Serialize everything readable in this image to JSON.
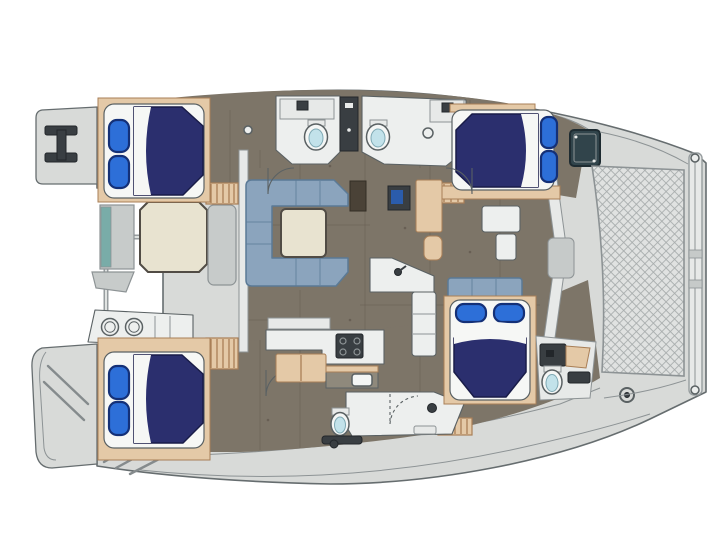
{
  "page": {
    "background": "#ffffff",
    "type": "yacht-floor-plan",
    "view": "top-down",
    "orientation": "bow-right"
  },
  "palette": {
    "paper": "#ffffff",
    "deck": "#d8dad8",
    "deck_mid": "#c6cac9",
    "deck_shadow": "#a9afae",
    "outline": "#666d6f",
    "line": "#5a6163",
    "line_soft": "#8d9395",
    "floor": "#7d7568",
    "floor_seam": "#685f54",
    "wood": "#e4c9a7",
    "wood_edge": "#a97f57",
    "mattress": "#f6f7f5",
    "bed": "#2b2f6e",
    "bed_edge": "#191c48",
    "pillow": "#2d6fd8",
    "pillow_edge": "#143077",
    "sofa": "#8ba4bd",
    "sofa_edge": "#5b7a96",
    "table": "#e8e3d0",
    "table_edge": "#514c45",
    "counter": "#edefee",
    "wall": "#e7e9e8",
    "dark": "#393e42",
    "dark_edge": "#22262a",
    "fixture": "#f4f6f5",
    "basin": "#c2e2ea",
    "basin_edge": "#7fa9b4",
    "rail": "#979d9f",
    "rail_hi": "#e9ebea",
    "step_line": "#858b8d",
    "mesh_bg": "#e0e2e1",
    "mesh_line": "#a7acac",
    "teal": "#79aca8",
    "hatch": "#31444b",
    "hatch_edge": "#1e2b31",
    "screen_blue": "#2b5cab",
    "storage": "#c7cbca"
  },
  "vessel": {
    "layout": "4-cabin catamaran floor plan",
    "hulls": 2,
    "cabins": [
      {
        "id": "aft-top-cabin",
        "bed": "double",
        "pillows": 2
      },
      {
        "id": "forward-top-cabin",
        "bed": "double",
        "pillows": 2
      },
      {
        "id": "aft-bottom-cabin",
        "bed": "double",
        "pillows": 2
      },
      {
        "id": "forward-bottom-cabin",
        "bed": "double",
        "pillows": 2
      }
    ],
    "heads": [
      {
        "id": "top-aft-head",
        "fixtures": [
          "toilet",
          "sink-counter"
        ]
      },
      {
        "id": "top-forward-head",
        "fixtures": [
          "toilet",
          "sink-counter"
        ]
      },
      {
        "id": "bottom-shower-room",
        "fixtures": [
          "toilet",
          "shower",
          "bench"
        ]
      },
      {
        "id": "bottom-forward-head",
        "fixtures": [
          "toilet",
          "vanity"
        ]
      }
    ],
    "saloon": {
      "sofa": "C-shaped",
      "coffee_table": 1,
      "island_faucet": 1,
      "tv_cabinet": 1
    },
    "galley": {
      "stove_burners": 4,
      "sink": 1,
      "drawers": 2
    },
    "cockpit": {
      "table_shape": "octagon",
      "wet_bar_burners": 2,
      "storage_units": 1,
      "bench": 1
    },
    "stern": {
      "swim_platforms": 2,
      "boarding_step_flights": 2,
      "rail": 1,
      "cleat": 1
    },
    "bow": {
      "trampoline": 1,
      "forestay_beam": 1,
      "anchor_roller": 1
    },
    "companionways": 2,
    "wardrobes": 2,
    "door_arcs": 4
  }
}
